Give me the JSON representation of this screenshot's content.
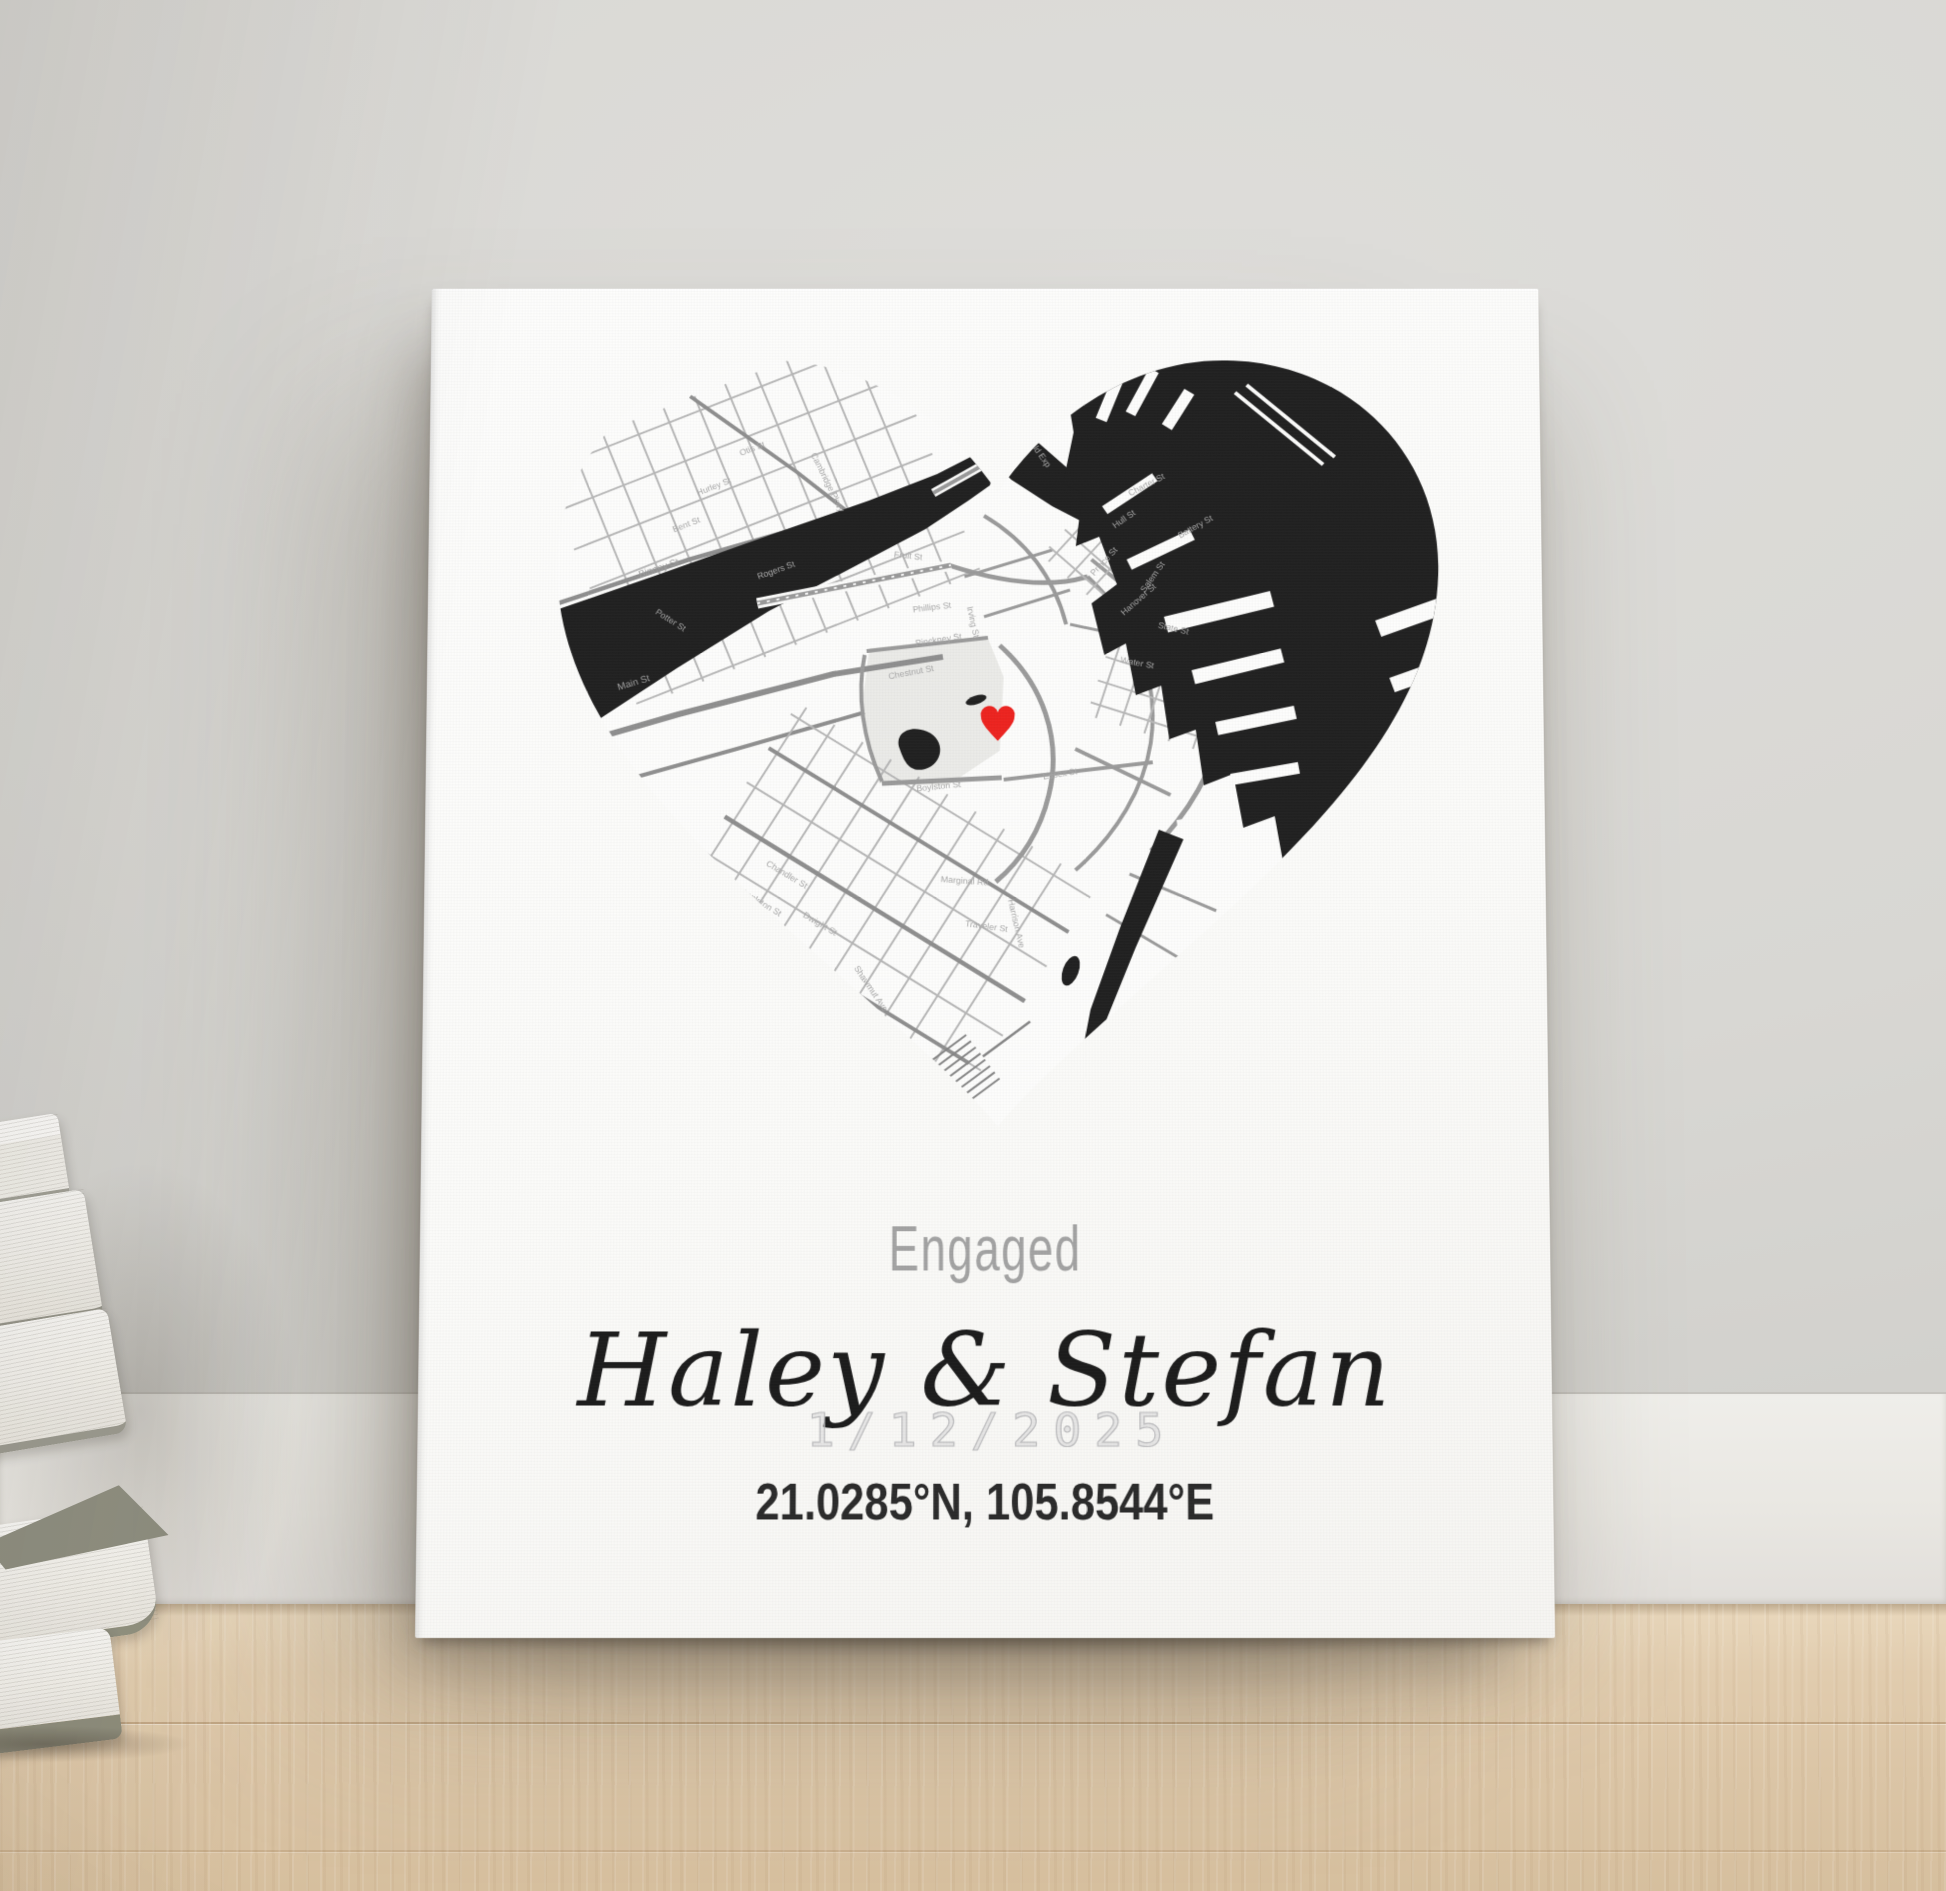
{
  "poster": {
    "occasion": "Engaged",
    "names": "Haley & Stefan",
    "date": "1/12/2025",
    "coordinates": "21.0285°N, 105.8544°E"
  },
  "map": {
    "marker_icon": "heart-marker",
    "streets": [
      {
        "name": "Otis St"
      },
      {
        "name": "Hurley St"
      },
      {
        "name": "Bent St"
      },
      {
        "name": "Binney St"
      },
      {
        "name": "Rogers St"
      },
      {
        "name": "Potter St"
      },
      {
        "name": "Main St"
      },
      {
        "name": "Cambridge Pkwy"
      },
      {
        "name": "Fitzgerald Exp"
      },
      {
        "name": "Charter St"
      },
      {
        "name": "Hull St"
      },
      {
        "name": "Prince St"
      },
      {
        "name": "Salem St"
      },
      {
        "name": "Battery St"
      },
      {
        "name": "Hanover St"
      },
      {
        "name": "Fruit St"
      },
      {
        "name": "Phillips St"
      },
      {
        "name": "Irving St"
      },
      {
        "name": "Pinckney St"
      },
      {
        "name": "Chestnut St"
      },
      {
        "name": "Boylston St"
      },
      {
        "name": "Essex St"
      },
      {
        "name": "Water St"
      },
      {
        "name": "State St"
      },
      {
        "name": "Chandler St"
      },
      {
        "name": "Appleton St"
      },
      {
        "name": "Dwight St"
      },
      {
        "name": "Shawmut Ave"
      },
      {
        "name": "Marginal Rd"
      },
      {
        "name": "Traveler St"
      },
      {
        "name": "Harrison Ave"
      }
    ]
  },
  "colors": {
    "wall": "#d8d7d3",
    "baseboard": "#eceae6",
    "floor_wood": "#ddc8ab",
    "canvas": "#fbfbfa",
    "map_water": "#212121",
    "map_street_main": "#8f8f8f",
    "map_street_thin": "#b7b7b7",
    "map_park": "#ebebe8",
    "marker_red": "#ed2420",
    "occasion_text": "#a3a3a3",
    "names_text": "#1c1c1c",
    "date_text": "#bcbcbe",
    "coords_text": "#2b2b2b",
    "book_cover": "#90907f",
    "book_pages": "#f4f2ee"
  }
}
